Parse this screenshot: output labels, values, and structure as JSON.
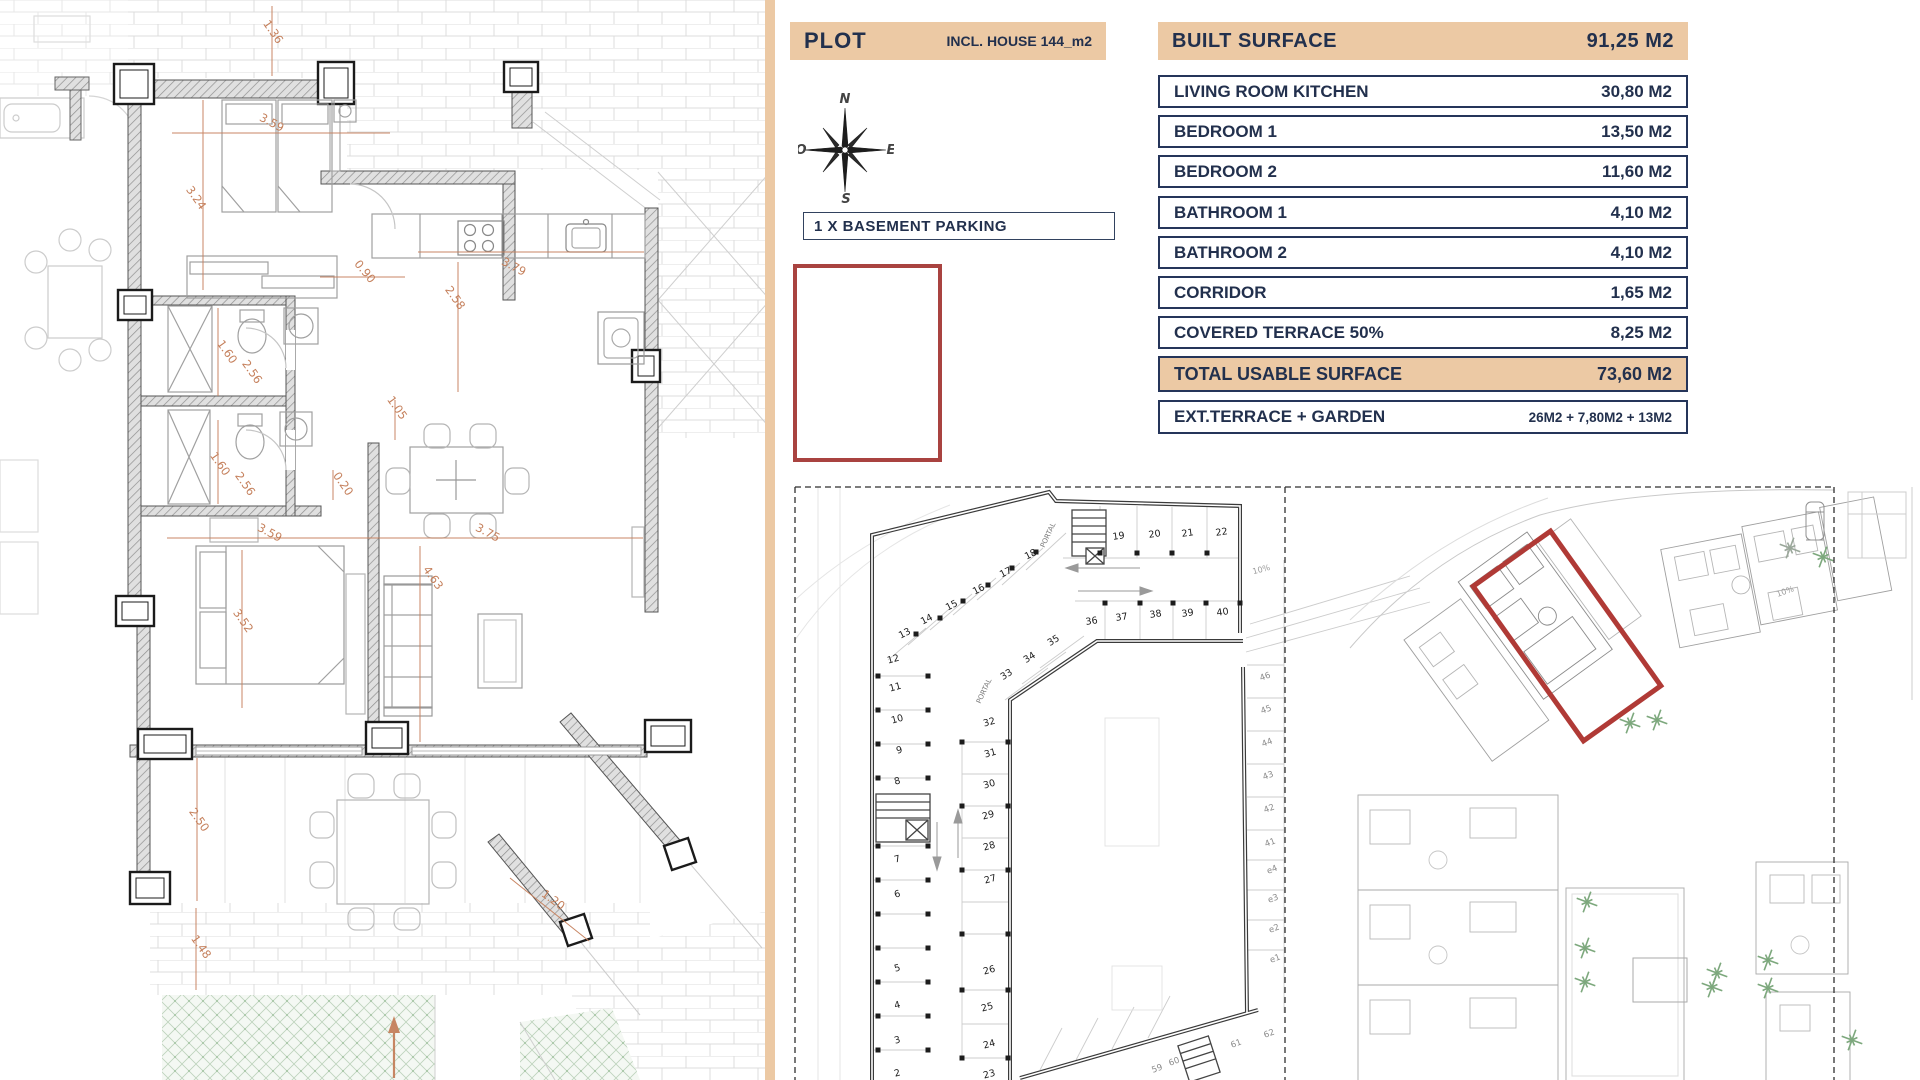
{
  "colors": {
    "tan": "#ecc9a4",
    "navy": "#22304d",
    "red": "#a94340",
    "dim_orange": "#c5805c",
    "garden_green": "#9cbf9b"
  },
  "plot_header": {
    "title": "PLOT",
    "subtitle": "INCL. HOUSE 144_m2"
  },
  "basement_note": "1 X BASEMENT PARKING",
  "compass": {
    "north": "N",
    "east": "E",
    "south": "S",
    "west": "O"
  },
  "surface_table": {
    "header": {
      "label": "BUILT SURFACE",
      "value": "91,25 M2"
    },
    "rows": [
      {
        "label": "LIVING ROOM KITCHEN",
        "value": "30,80 M2"
      },
      {
        "label": "BEDROOM 1",
        "value": "13,50 M2"
      },
      {
        "label": "BEDROOM 2",
        "value": "11,60 M2"
      },
      {
        "label": "BATHROOM 1",
        "value": "4,10 M2"
      },
      {
        "label": "BATHROOM 2",
        "value": "4,10 M2"
      },
      {
        "label": "CORRIDOR",
        "value": "1,65 M2"
      },
      {
        "label": "COVERED TERRACE 50%",
        "value": "8,25 M2"
      }
    ],
    "total": {
      "label": "TOTAL USABLE SURFACE",
      "value": "73,60 M2"
    },
    "exterior": {
      "label": "EXT.TERRACE + GARDEN",
      "value": "26M2 + 7,80M2 + 13M2"
    }
  },
  "floorplan": {
    "dims": [
      {
        "t": "1.36",
        "x": 270,
        "y": 34,
        "r": 55
      },
      {
        "t": "3.24",
        "x": 193,
        "y": 200,
        "r": 55
      },
      {
        "t": "3.59",
        "x": 270,
        "y": 126,
        "r": 28
      },
      {
        "t": "0.90",
        "x": 362,
        "y": 274,
        "r": 50
      },
      {
        "t": "2.58",
        "x": 452,
        "y": 300,
        "r": 55
      },
      {
        "t": "3.79",
        "x": 512,
        "y": 270,
        "r": 28
      },
      {
        "t": "1.60",
        "x": 224,
        "y": 354,
        "r": 55
      },
      {
        "t": "2.56",
        "x": 249,
        "y": 374,
        "r": 55
      },
      {
        "t": "1.60",
        "x": 217,
        "y": 466,
        "r": 55
      },
      {
        "t": "2.56",
        "x": 242,
        "y": 486,
        "r": 55
      },
      {
        "t": "1.05",
        "x": 394,
        "y": 410,
        "r": 55
      },
      {
        "t": "0.20",
        "x": 340,
        "y": 486,
        "r": 55
      },
      {
        "t": "3.59",
        "x": 268,
        "y": 536,
        "r": 28
      },
      {
        "t": "3.75",
        "x": 486,
        "y": 536,
        "r": 28
      },
      {
        "t": "4.63",
        "x": 430,
        "y": 580,
        "r": 55
      },
      {
        "t": "3.52",
        "x": 240,
        "y": 623,
        "r": 55
      },
      {
        "t": "2.50",
        "x": 196,
        "y": 822,
        "r": 55
      },
      {
        "t": "1.48",
        "x": 198,
        "y": 949,
        "r": 55
      },
      {
        "t": "1.20",
        "x": 551,
        "y": 903,
        "r": 36
      }
    ]
  },
  "parking": {
    "spots": [
      {
        "t": "1",
        "x": 898,
        "y": 1112,
        "r": -15
      },
      {
        "t": "2",
        "x": 898,
        "y": 1076,
        "r": -15
      },
      {
        "t": "3",
        "x": 898,
        "y": 1043,
        "r": -15
      },
      {
        "t": "4",
        "x": 898,
        "y": 1008,
        "r": -15
      },
      {
        "t": "5",
        "x": 898,
        "y": 971,
        "r": -15
      },
      {
        "t": "6",
        "x": 898,
        "y": 897,
        "r": -15
      },
      {
        "t": "7",
        "x": 898,
        "y": 862,
        "r": -15
      },
      {
        "t": "8",
        "x": 898,
        "y": 784,
        "r": -15
      },
      {
        "t": "9",
        "x": 900,
        "y": 753,
        "r": -15
      },
      {
        "t": "10",
        "x": 898,
        "y": 722,
        "r": -15
      },
      {
        "t": "11",
        "x": 896,
        "y": 690,
        "r": -15
      },
      {
        "t": "12",
        "x": 894,
        "y": 662,
        "r": -15
      },
      {
        "t": "13",
        "x": 906,
        "y": 636,
        "r": -27
      },
      {
        "t": "14",
        "x": 928,
        "y": 622,
        "r": -27
      },
      {
        "t": "15",
        "x": 953,
        "y": 608,
        "r": -27
      },
      {
        "t": "16",
        "x": 980,
        "y": 592,
        "r": -27
      },
      {
        "t": "17",
        "x": 1007,
        "y": 575,
        "r": -27
      },
      {
        "t": "18",
        "x": 1032,
        "y": 557,
        "r": -27
      },
      {
        "t": "19",
        "x": 1119,
        "y": 539,
        "r": -8
      },
      {
        "t": "20",
        "x": 1155,
        "y": 537,
        "r": -8
      },
      {
        "t": "21",
        "x": 1188,
        "y": 536,
        "r": -8
      },
      {
        "t": "22",
        "x": 1222,
        "y": 535,
        "r": -8
      },
      {
        "t": "23",
        "x": 990,
        "y": 1077,
        "r": -15
      },
      {
        "t": "24",
        "x": 990,
        "y": 1047,
        "r": -15
      },
      {
        "t": "25",
        "x": 988,
        "y": 1010,
        "r": -15
      },
      {
        "t": "26",
        "x": 990,
        "y": 973,
        "r": -15
      },
      {
        "t": "27",
        "x": 991,
        "y": 882,
        "r": -15
      },
      {
        "t": "28",
        "x": 990,
        "y": 849,
        "r": -15
      },
      {
        "t": "29",
        "x": 989,
        "y": 818,
        "r": -15
      },
      {
        "t": "30",
        "x": 990,
        "y": 787,
        "r": -15
      },
      {
        "t": "31",
        "x": 991,
        "y": 756,
        "r": -15
      },
      {
        "t": "32",
        "x": 990,
        "y": 725,
        "r": -15
      },
      {
        "t": "33",
        "x": 1008,
        "y": 677,
        "r": -32
      },
      {
        "t": "34",
        "x": 1031,
        "y": 660,
        "r": -32
      },
      {
        "t": "35",
        "x": 1055,
        "y": 643,
        "r": -32
      },
      {
        "t": "36",
        "x": 1092,
        "y": 624,
        "r": -8
      },
      {
        "t": "37",
        "x": 1122,
        "y": 620,
        "r": -8
      },
      {
        "t": "38",
        "x": 1156,
        "y": 617,
        "r": -8
      },
      {
        "t": "39",
        "x": 1188,
        "y": 616,
        "r": -8
      },
      {
        "t": "40",
        "x": 1223,
        "y": 615,
        "r": -8
      }
    ],
    "storage": [
      {
        "t": "46",
        "x": 1266,
        "y": 679,
        "r": -20
      },
      {
        "t": "45",
        "x": 1267,
        "y": 712,
        "r": -20
      },
      {
        "t": "44",
        "x": 1268,
        "y": 745,
        "r": -20
      },
      {
        "t": "43",
        "x": 1269,
        "y": 778,
        "r": -20
      },
      {
        "t": "42",
        "x": 1270,
        "y": 811,
        "r": -20
      },
      {
        "t": "41",
        "x": 1271,
        "y": 845,
        "r": -20
      },
      {
        "t": "e4",
        "x": 1273,
        "y": 872,
        "r": -20
      },
      {
        "t": "e3",
        "x": 1274,
        "y": 901,
        "r": -20
      },
      {
        "t": "e2",
        "x": 1275,
        "y": 931,
        "r": -20
      },
      {
        "t": "e1",
        "x": 1276,
        "y": 961,
        "r": -20
      },
      {
        "t": "59",
        "x": 1158,
        "y": 1071,
        "r": -20
      },
      {
        "t": "60",
        "x": 1175,
        "y": 1064,
        "r": -20
      },
      {
        "t": "61",
        "x": 1237,
        "y": 1046,
        "r": -20
      },
      {
        "t": "62",
        "x": 1270,
        "y": 1036,
        "r": -20
      }
    ],
    "ramp_labels": [
      {
        "t": "10%",
        "x": 1262,
        "y": 572,
        "r": -15
      }
    ],
    "portal_labels": [
      {
        "t": "PORTAL",
        "x": 1050,
        "y": 536,
        "r": -65
      },
      {
        "t": "PORTAL",
        "x": 986,
        "y": 692,
        "r": -65
      }
    ],
    "pillars": [
      {
        "x": 878,
        "y": 676
      },
      {
        "x": 928,
        "y": 676
      },
      {
        "x": 878,
        "y": 710
      },
      {
        "x": 928,
        "y": 710
      },
      {
        "x": 878,
        "y": 744
      },
      {
        "x": 928,
        "y": 744
      },
      {
        "x": 878,
        "y": 778
      },
      {
        "x": 928,
        "y": 778
      },
      {
        "x": 878,
        "y": 846
      },
      {
        "x": 928,
        "y": 846
      },
      {
        "x": 878,
        "y": 880
      },
      {
        "x": 928,
        "y": 880
      },
      {
        "x": 878,
        "y": 914
      },
      {
        "x": 928,
        "y": 914
      },
      {
        "x": 878,
        "y": 948
      },
      {
        "x": 928,
        "y": 948
      },
      {
        "x": 878,
        "y": 982
      },
      {
        "x": 928,
        "y": 982
      },
      {
        "x": 878,
        "y": 1016
      },
      {
        "x": 928,
        "y": 1016
      },
      {
        "x": 878,
        "y": 1050
      },
      {
        "x": 928,
        "y": 1050
      },
      {
        "x": 962,
        "y": 742
      },
      {
        "x": 1008,
        "y": 742
      },
      {
        "x": 962,
        "y": 806
      },
      {
        "x": 1008,
        "y": 806
      },
      {
        "x": 962,
        "y": 870
      },
      {
        "x": 1008,
        "y": 870
      },
      {
        "x": 962,
        "y": 934
      },
      {
        "x": 1008,
        "y": 934
      },
      {
        "x": 962,
        "y": 990
      },
      {
        "x": 1008,
        "y": 990
      },
      {
        "x": 962,
        "y": 1058
      },
      {
        "x": 1008,
        "y": 1058
      },
      {
        "x": 1100,
        "y": 553
      },
      {
        "x": 1137,
        "y": 553
      },
      {
        "x": 1172,
        "y": 553
      },
      {
        "x": 1207,
        "y": 553
      },
      {
        "x": 1105,
        "y": 603
      },
      {
        "x": 1140,
        "y": 603
      },
      {
        "x": 1173,
        "y": 603
      },
      {
        "x": 1206,
        "y": 603
      },
      {
        "x": 1240,
        "y": 603
      },
      {
        "x": 916,
        "y": 634
      },
      {
        "x": 940,
        "y": 618
      },
      {
        "x": 963,
        "y": 601
      },
      {
        "x": 988,
        "y": 585
      },
      {
        "x": 1012,
        "y": 568
      },
      {
        "x": 1036,
        "y": 552
      }
    ]
  },
  "siteplan": {
    "ramp_labels": [
      {
        "t": "10%",
        "x": 1786,
        "y": 594,
        "r": -20
      }
    ],
    "palms": [
      {
        "x": 1630,
        "y": 723
      },
      {
        "x": 1657,
        "y": 720
      },
      {
        "x": 1587,
        "y": 902
      },
      {
        "x": 1585,
        "y": 948
      },
      {
        "x": 1585,
        "y": 982
      },
      {
        "x": 1717,
        "y": 973
      },
      {
        "x": 1768,
        "y": 960
      },
      {
        "x": 1768,
        "y": 988
      },
      {
        "x": 1790,
        "y": 548,
        "c": "#9aa79a"
      },
      {
        "x": 1823,
        "y": 557
      },
      {
        "x": 1712,
        "y": 987
      },
      {
        "x": 1852,
        "y": 1040
      }
    ]
  }
}
